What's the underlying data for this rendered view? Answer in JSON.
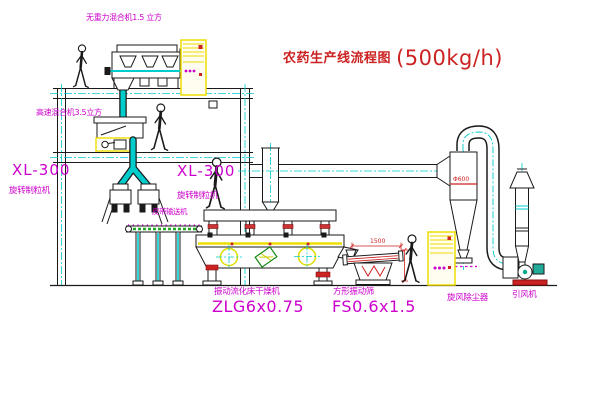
{
  "title": {
    "zh": "农药生产线流程图",
    "capacity": "(500kg/h)"
  },
  "labels": {
    "mixer_top": "无重力混合机1.5 立方",
    "mixer_highspeed": "高速混合机3.5立方",
    "granulator_model_left": "XL-300",
    "granulator_name_left": "旋转制粒机",
    "granulator_model_mid": "XL-300",
    "granulator_name_mid": "旋转制粒机",
    "belt_conveyor": "皮带输送机",
    "dryer_name": "振动流化床干燥机",
    "dryer_model": "ZLG6x0.75",
    "screen_name": "方形振动筛",
    "screen_model": "FS0.6x1.5",
    "cyclone": "旋风除尘器",
    "fan": "引风机"
  },
  "dimensions": {
    "screen_length": "1500",
    "cyclone_diameter": "Φ600"
  },
  "colors": {
    "line": "#1a1a1a",
    "pipe_cyan": "#00cccc",
    "label_magenta": "#cc00cc",
    "title_red": "#cc2222",
    "cabinet_yellow": "#eedd00",
    "machine_green": "#118811",
    "belt_green": "#22aa22"
  }
}
